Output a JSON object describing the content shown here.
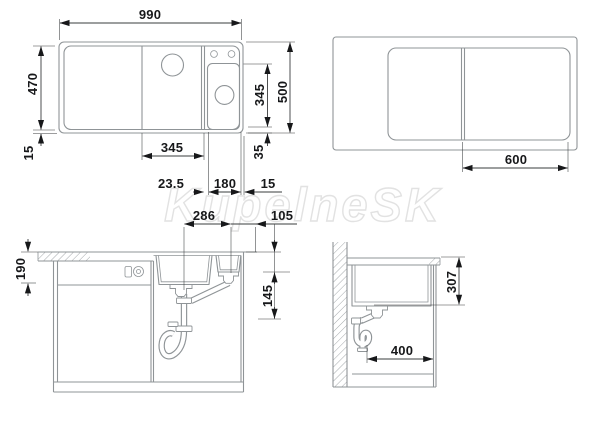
{
  "watermark": "KupelneSK",
  "colors": {
    "bg": "#ffffff",
    "outline": "#8f9497",
    "dim": "#3a3c3e",
    "ink": "#17181a",
    "watermark": "#e2e2e2"
  },
  "plan_view": {
    "overall_width": "990",
    "inner_depth": "470",
    "left_edge_offset": "15",
    "main_bowl_width": "345",
    "small_bowl_depth": "345",
    "overall_depth": "500",
    "bottom_rim_offset": "35",
    "divider_to_small_bowl": "23.5",
    "small_bowl_width": "180",
    "right_edge_offset": "15"
  },
  "board_view": {
    "board_width": "600"
  },
  "front_section": {
    "bowl_depth": "190",
    "drain_spacing": "286",
    "drain_to_edge": "105",
    "outlet_drop": "145"
  },
  "side_section": {
    "counter_to_outlet": "307",
    "cabinet_depth": "400"
  }
}
